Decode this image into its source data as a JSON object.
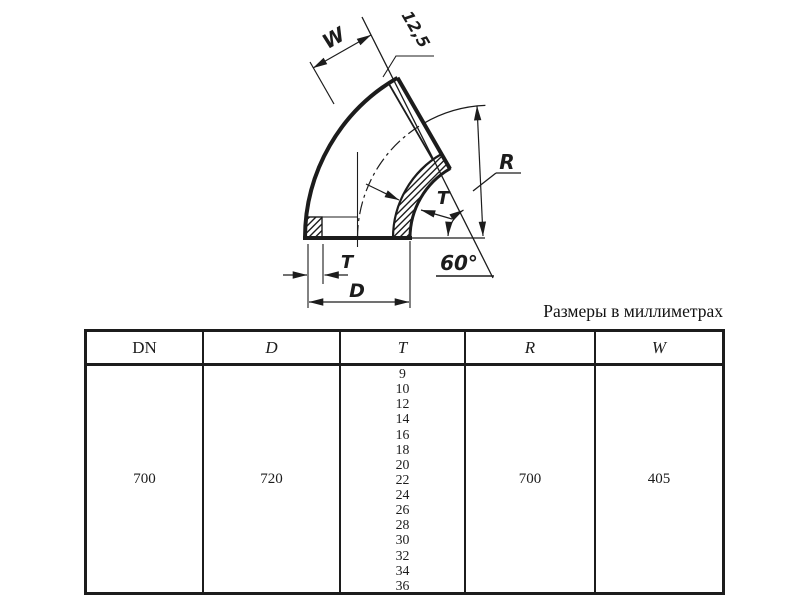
{
  "note": "Размеры в миллиметрах",
  "drawing": {
    "labels": {
      "width": "W",
      "chamfer": "12,5",
      "radius": "R",
      "wall_thickness": "T",
      "wall_thickness_bottom": "T",
      "diameter": "D",
      "angle": "60°"
    }
  },
  "table": {
    "headers": [
      "DN",
      "D",
      "T",
      "R",
      "W"
    ],
    "row": {
      "dn": "700",
      "d": "720",
      "r": "700",
      "w": "405"
    },
    "t_values": [
      "9",
      "10",
      "12",
      "14",
      "16",
      "18",
      "20",
      "22",
      "24",
      "26",
      "28",
      "30",
      "32",
      "34",
      "36"
    ]
  },
  "colors": {
    "ink": "#1c1c1c",
    "background": "#ffffff"
  }
}
